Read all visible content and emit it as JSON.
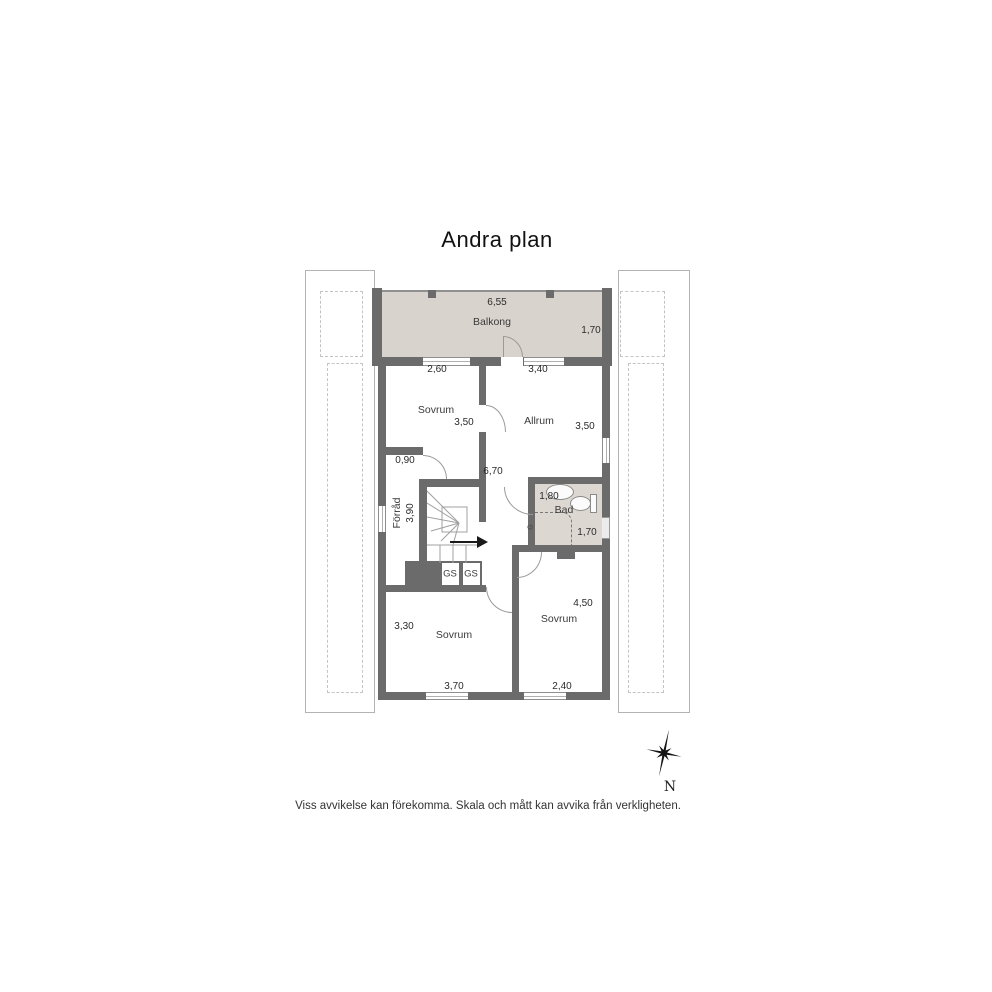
{
  "title": "Andra plan",
  "disclaimer": "Viss avvikelse kan förekomma. Skala och mått kan avvika från verkligheten.",
  "compass": {
    "north_label": "N"
  },
  "colors": {
    "wall": "#6b6b6b",
    "balcony_fill": "#d8d3cd",
    "bathroom_fill": "#ddd7d1"
  },
  "floor_plan": {
    "balcony": {
      "name": "Balkong",
      "width": "6,55",
      "depth": "1,70"
    },
    "bedroom_top": {
      "name": "Sovrum",
      "depth": "3,50",
      "window_width": "2,60"
    },
    "living_room": {
      "name": "Allrum",
      "depth": "3,50",
      "window_width": "3,40"
    },
    "hall": {
      "length": "6,70",
      "opening_width": "0,90"
    },
    "storage": {
      "name": "Förråd",
      "length": "3,90"
    },
    "bathroom": {
      "name": "Bad",
      "width": "1,80",
      "depth": "1,70",
      "cabinet": "G"
    },
    "closets": {
      "left": "GS",
      "right": "GS"
    },
    "bedroom_left": {
      "name": "Sovrum",
      "width": "3,30",
      "window_width": "3,70"
    },
    "bedroom_right": {
      "name": "Sovrum",
      "depth": "4,50",
      "window_width": "2,40"
    }
  }
}
